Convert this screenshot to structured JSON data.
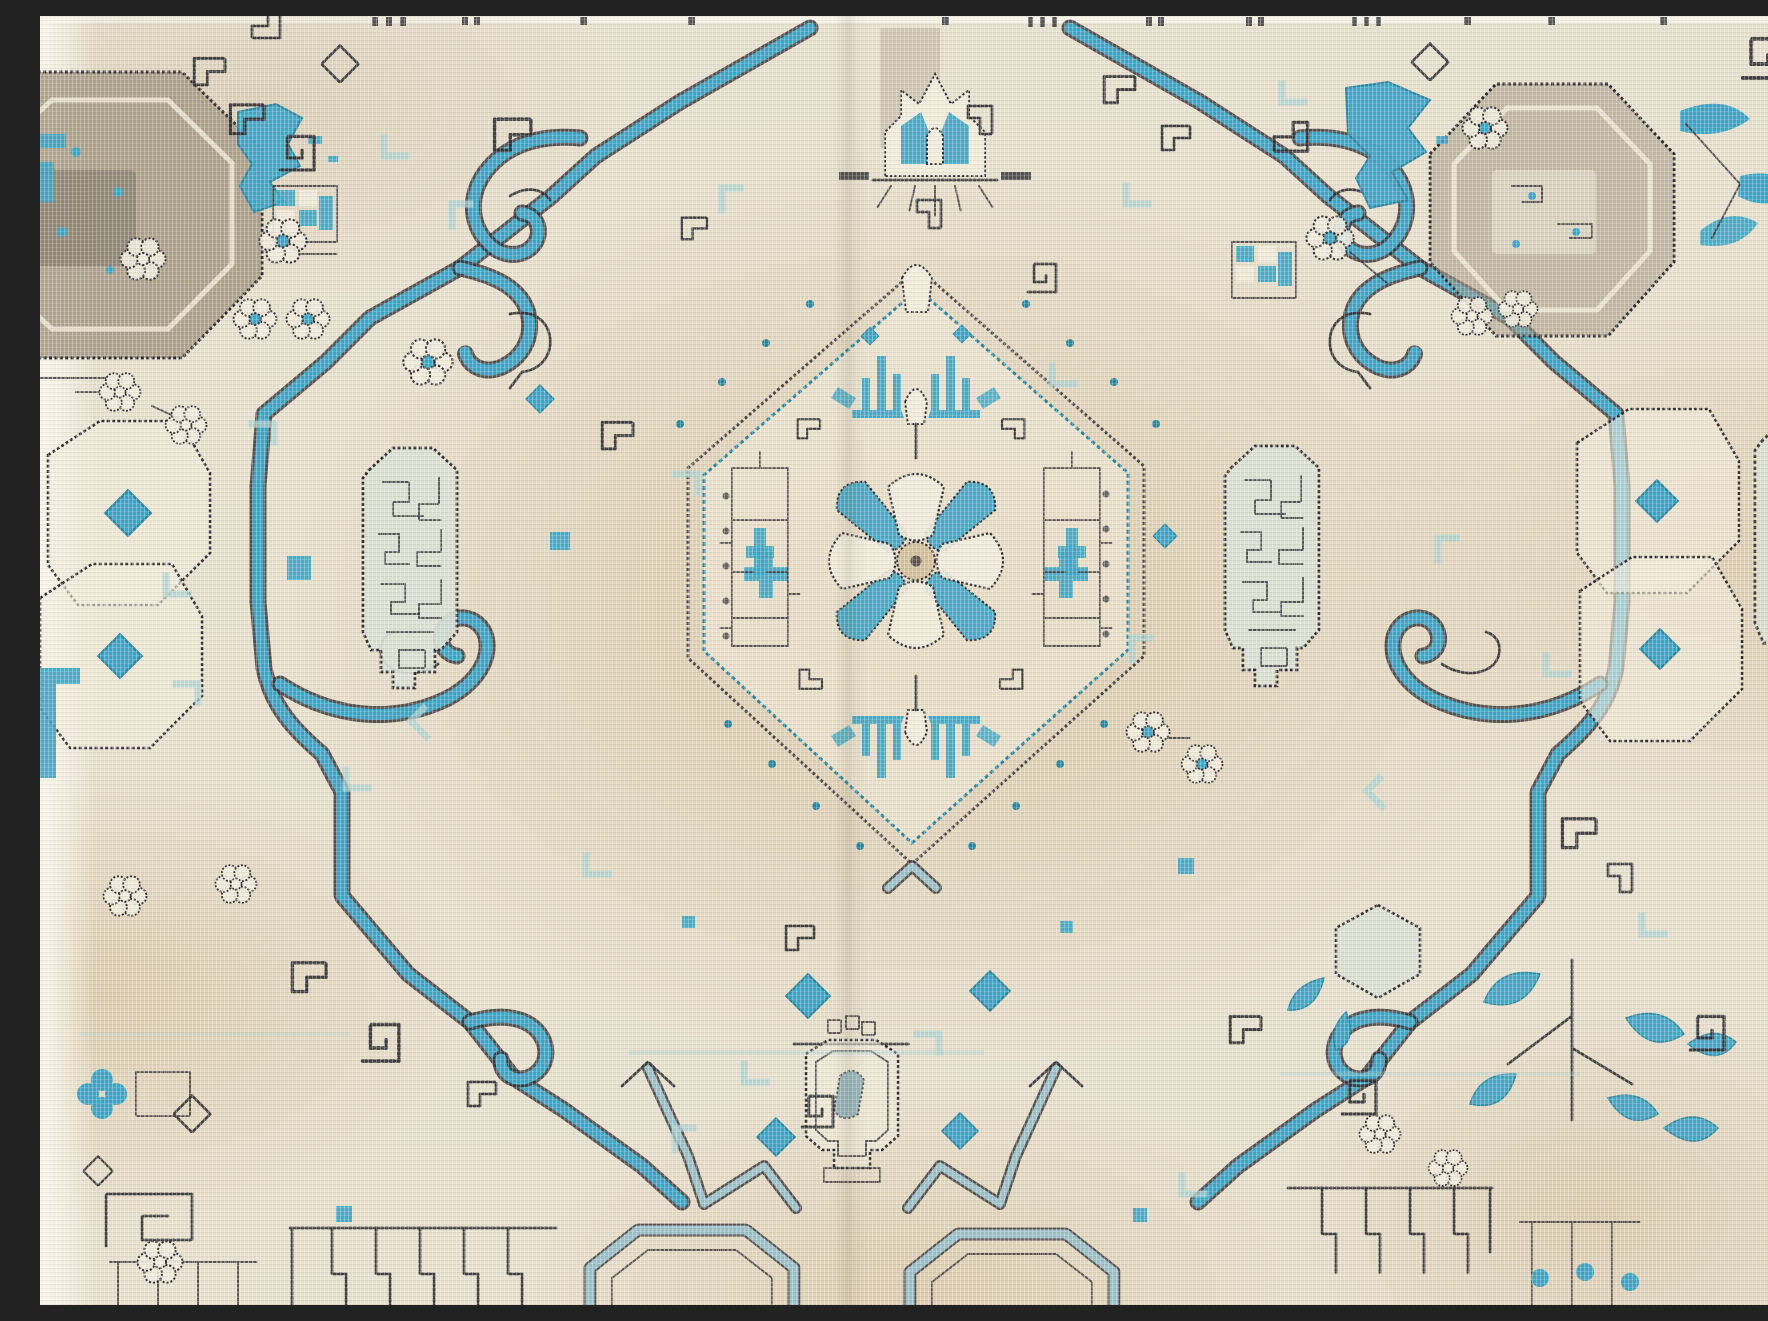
{
  "photo": {
    "kind": "photograph",
    "alt": "Close-up photograph of a vintage hand-knotted rug in cream and soft beige with turquoise accents and charcoal stitched outlines. A central hexagonal medallion with a pearl-dotted border holds an eight-petal turquoise rosette and palmette sprays, flanked by Greek-key fret panels. A thick turquoise scroll cartouche with curled hooks frames the field; corner octagons, rosette flowers, diamond guls, steel-blue chevrons, a pendant octagon and comb-like border fragments fill the surround."
  },
  "palette": {
    "cream": "#e7dfcd",
    "cream2": "#f1ebdb",
    "tan": "#d2bf9b",
    "tan2": "#c6ae83",
    "teal": "#3aa6c5",
    "teal2": "#27859f",
    "aqua": "#abd2d0",
    "steel": "#9cc0c8",
    "steel2": "#7fa9b4",
    "ink": "#2e2c31",
    "taupe": "#a29681",
    "taupe2": "#8a8071",
    "celadon": "#d9dfd2",
    "white": "#f7f4ec"
  },
  "motifs": [
    "central-hexagon-medallion",
    "eight-petal-rosette",
    "palmette-sprays",
    "greek-key-fret-panels",
    "turquoise-scroll-cartouche",
    "scroll-hook-curls",
    "corner-octagons",
    "pearl-dot-border",
    "pendant-octagon",
    "crown-palmette",
    "rosette-flowers",
    "diamond-guls",
    "steel-chevrons",
    "comb-border-fragments",
    "teal-abrash-patches",
    "hexagon-side-panels",
    "teal-leaf-sprays"
  ]
}
